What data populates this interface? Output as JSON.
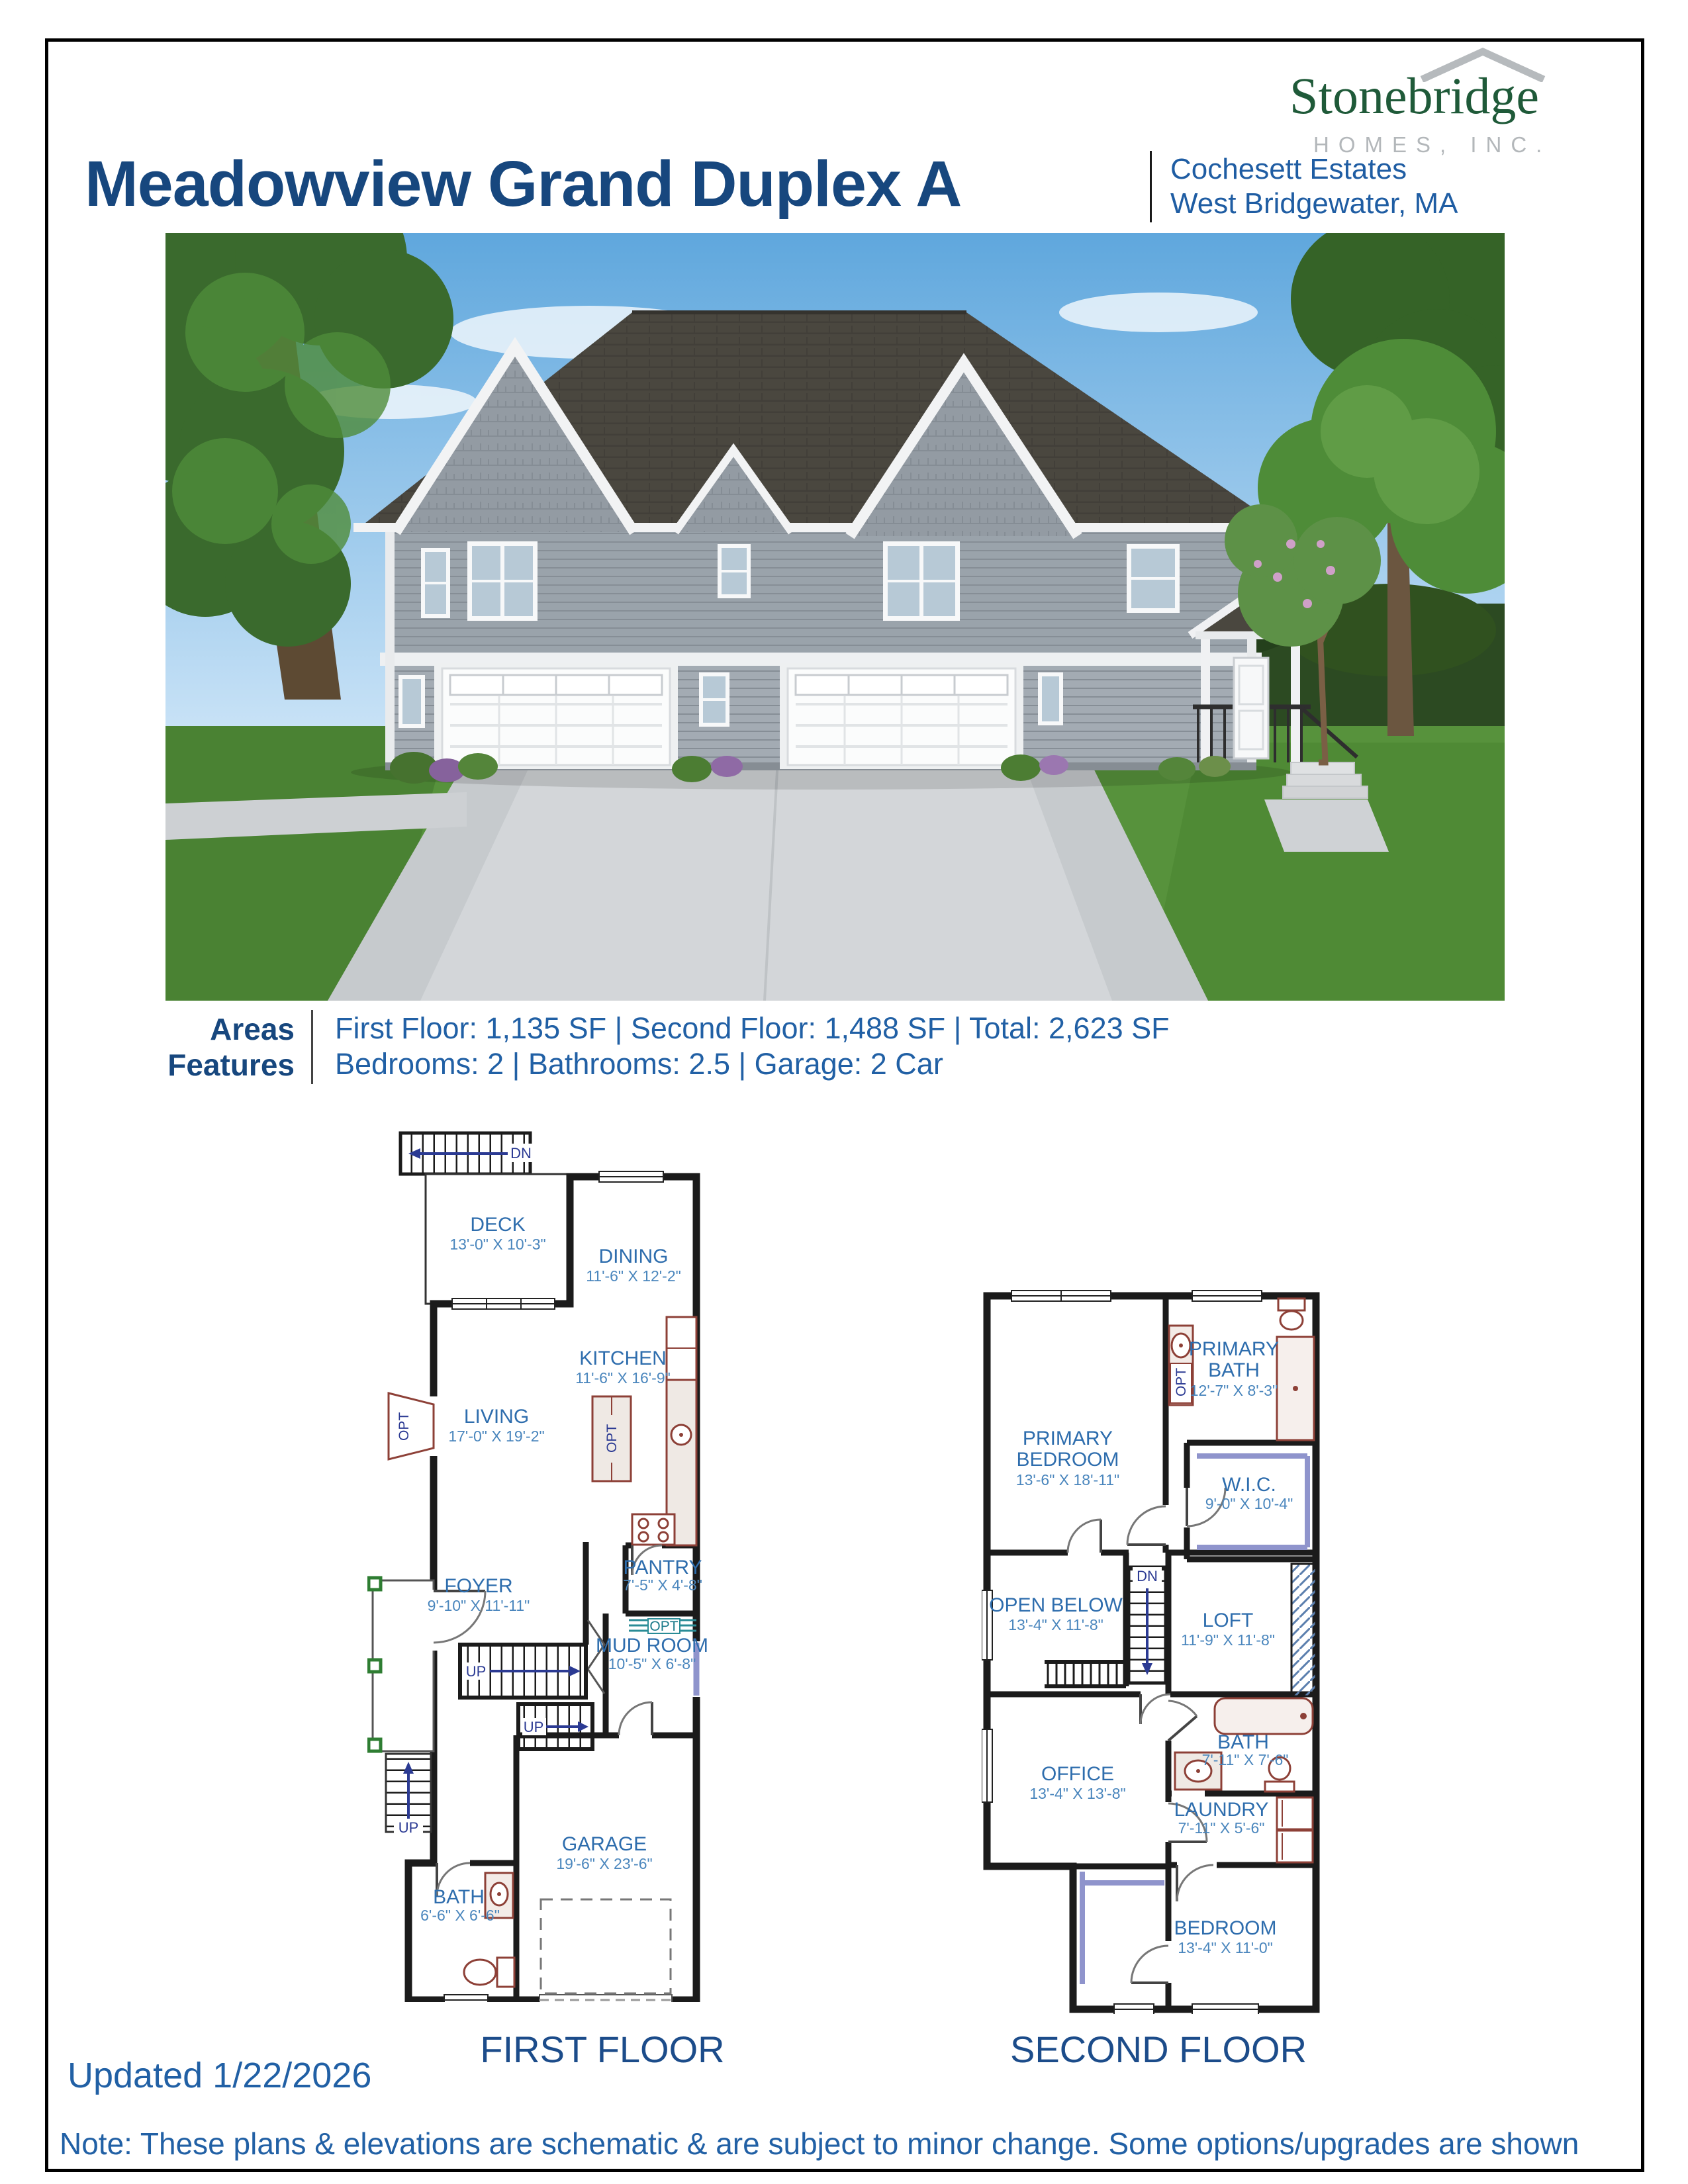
{
  "header": {
    "title": "Meadowview Grand Duplex A",
    "location1": "Cochesett Estates",
    "location2": "West Bridgewater, MA"
  },
  "logo": {
    "name": "Stonebridge",
    "subtitle": "HOMES, INC."
  },
  "specs": {
    "areas_label": "Areas",
    "areas_value": "First Floor: 1,135 SF | Second Floor: 1,488 SF | Total: 2,623 SF",
    "features_label": "Features",
    "features_value": "Bedrooms: 2 | Bathrooms: 2.5 | Garage: 2 Car"
  },
  "labels": {
    "up": "UP",
    "dn": "DN",
    "opt": "OPT"
  },
  "floorplans": {
    "first": {
      "caption": "FIRST FLOOR",
      "rooms": [
        {
          "name": "DECK",
          "dims": "13'-0\" X 10'-3\""
        },
        {
          "name": "DINING",
          "dims": "11'-6\" X 12'-2\""
        },
        {
          "name": "KITCHEN",
          "dims": "11'-6\" X 16'-9\""
        },
        {
          "name": "LIVING",
          "dims": "17'-0\" X 19'-2\""
        },
        {
          "name": "FOYER",
          "dims": "9'-10\" X 11'-11\""
        },
        {
          "name": "PANTRY",
          "dims": "7'-5\" X 4'-8\""
        },
        {
          "name": "MUD ROOM",
          "dims": "10'-5\" X 6'-8\""
        },
        {
          "name": "BATH",
          "dims": "6'-6\" X 6'-6\""
        },
        {
          "name": "GARAGE",
          "dims": "19'-6\" X 23'-6\""
        }
      ]
    },
    "second": {
      "caption": "SECOND FLOOR",
      "rooms": [
        {
          "name": "PRIMARY",
          "name2": "BEDROOM",
          "dims": "13'-6\" X 18'-11\""
        },
        {
          "name": "PRIMARY",
          "name2": "BATH",
          "dims": "12'-7\" X 8'-3\""
        },
        {
          "name": "W.I.C.",
          "dims": "9'-0\" X 10'-4\""
        },
        {
          "name": "OPEN BELOW",
          "dims": "13'-4\" X 11'-8\""
        },
        {
          "name": "LOFT",
          "dims": "11'-9\" X 11'-8\""
        },
        {
          "name": "OFFICE",
          "dims": "13'-4\" X 13'-8\""
        },
        {
          "name": "BATH",
          "dims": "7'-11\" X 7'-6\""
        },
        {
          "name": "LAUNDRY",
          "dims": "7'-11\" X 5'-6\""
        },
        {
          "name": "BEDROOM",
          "dims": "13'-4\" X 11'-0\""
        }
      ]
    }
  },
  "footer": {
    "updated": "Updated 1/22/2026",
    "note": "Note: These plans & elevations are schematic & are subject to minor change. Some options/upgrades are shown"
  },
  "colors": {
    "heading": "#17477e",
    "body_blue": "#2160a5",
    "logo_green": "#1f5a39",
    "plan_label": "#2e6dad"
  }
}
